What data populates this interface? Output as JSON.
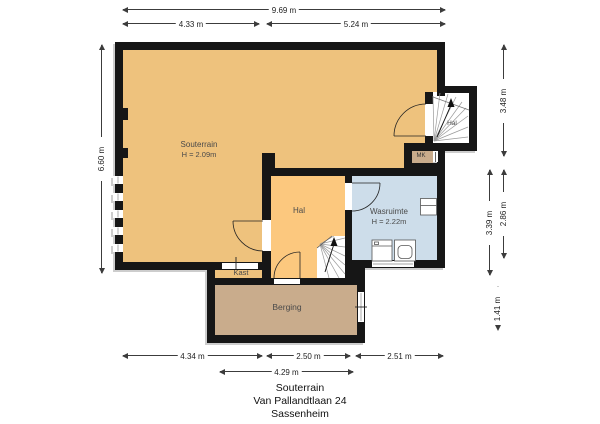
{
  "title_block": {
    "floor": "Souterrain",
    "address": "Van Pallandtlaan 24",
    "city": "Sassenheim"
  },
  "rooms": {
    "souterrain": {
      "name": "Souterrain",
      "height_label": "H = 2.09m"
    },
    "hal": {
      "name": "Hal"
    },
    "wasruimte": {
      "name": "Wasruimte",
      "height_label": "H = 2.22m"
    },
    "kast": {
      "name": "Kast"
    },
    "berging": {
      "name": "Berging"
    },
    "stair_hall": {
      "name": "Hal"
    },
    "meterkast": {
      "name": "MK"
    }
  },
  "dimensions": {
    "top": [
      {
        "label": "9.69 m"
      },
      {
        "label": "4.33 m"
      },
      {
        "label": "5.24 m"
      }
    ],
    "left": [
      {
        "label": "6.60 m"
      }
    ],
    "right": [
      {
        "label": "3.48 m"
      },
      {
        "label": "3.39 m"
      },
      {
        "label": "2.86 m"
      },
      {
        "label": "1.41 m"
      }
    ],
    "bottom": [
      {
        "label": "4.34 m"
      },
      {
        "label": "2.50 m"
      },
      {
        "label": "2.51 m"
      },
      {
        "label": "4.29 m"
      }
    ]
  },
  "colors": {
    "wall": "#161616",
    "souterrain_fill": "#eec27d",
    "hal_fill": "#fcc87e",
    "wasruimte_fill": "#cdddea",
    "berging_fill": "#c9ac8c",
    "background": "#ffffff"
  }
}
